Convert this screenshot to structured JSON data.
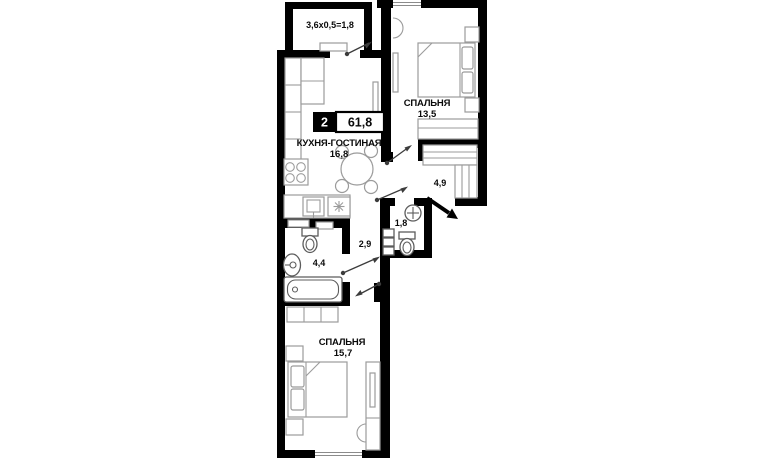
{
  "floorplan": {
    "badge": {
      "rooms_count": "2",
      "total_area": "61,8"
    },
    "balcony": {
      "dimensions": "3,6x0,5=1,8"
    },
    "rooms": [
      {
        "name": "СПАЛЬНЯ",
        "area": "13,5"
      },
      {
        "name": "КУХНЯ-ГОСТИНАЯ",
        "area": "16,8"
      },
      {
        "name": "СПАЛЬНЯ",
        "area": "15,7"
      }
    ],
    "spaces": [
      {
        "name": "hall",
        "area": "4,9"
      },
      {
        "name": "wc",
        "area": "1,8"
      },
      {
        "name": "corridor",
        "area": "2,9"
      },
      {
        "name": "bathroom",
        "area": "4,4"
      }
    ],
    "colors": {
      "wall": "#000000",
      "furniture": "#9b9b9b",
      "fixture": "#5c5c5c",
      "text": "#0a0a0a"
    }
  }
}
